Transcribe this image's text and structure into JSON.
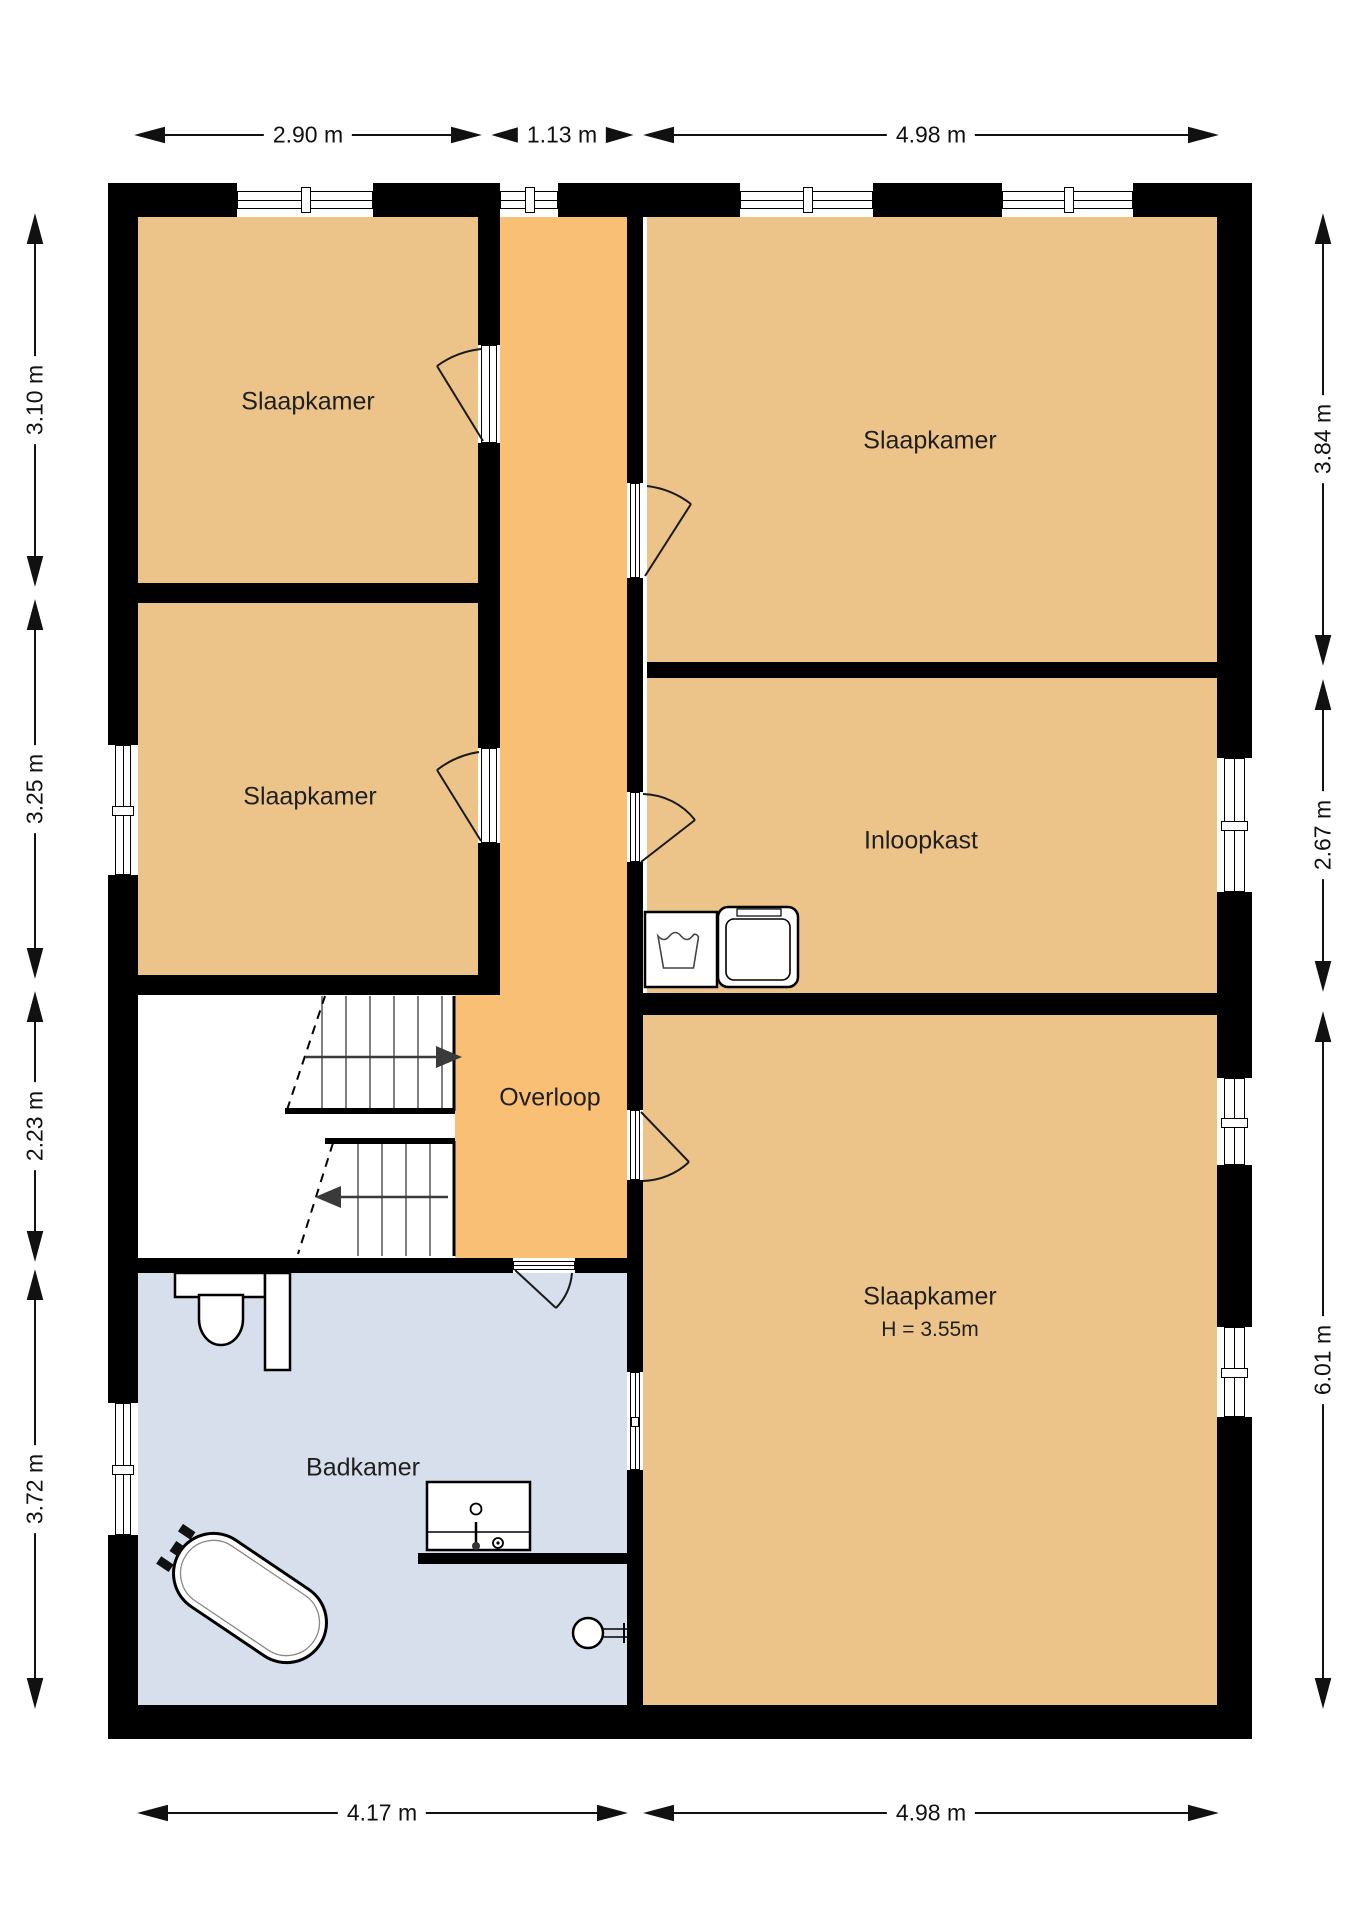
{
  "title": "Floor plan - first floor",
  "rooms": {
    "bedroom_top_left": {
      "label": "Slaapkamer"
    },
    "bedroom_mid_left": {
      "label": "Slaapkamer"
    },
    "bedroom_top_right": {
      "label": "Slaapkamer"
    },
    "walk_in_closet": {
      "label": "Inloopkast"
    },
    "landing": {
      "label": "Overloop"
    },
    "bedroom_bottom_right": {
      "label": "Slaapkamer",
      "height_note": "H = 3.55m"
    },
    "bathroom": {
      "label": "Badkamer"
    }
  },
  "dimensions": {
    "top": [
      {
        "label": "2.90 m"
      },
      {
        "label": "1.13 m"
      },
      {
        "label": "4.98 m"
      }
    ],
    "left": [
      {
        "label": "3.10 m"
      },
      {
        "label": "3.25 m"
      },
      {
        "label": "2.23 m"
      },
      {
        "label": "3.72 m"
      }
    ],
    "right": [
      {
        "label": "3.84 m"
      },
      {
        "label": "2.67 m"
      },
      {
        "label": "6.01 m"
      }
    ],
    "bottom": [
      {
        "label": "4.17 m"
      },
      {
        "label": "4.98 m"
      }
    ]
  },
  "colors": {
    "room_fill": "#ecc489",
    "landing_fill": "#f8bf75",
    "bathroom_fill": "#d6dfeb",
    "wall": "#000000"
  }
}
